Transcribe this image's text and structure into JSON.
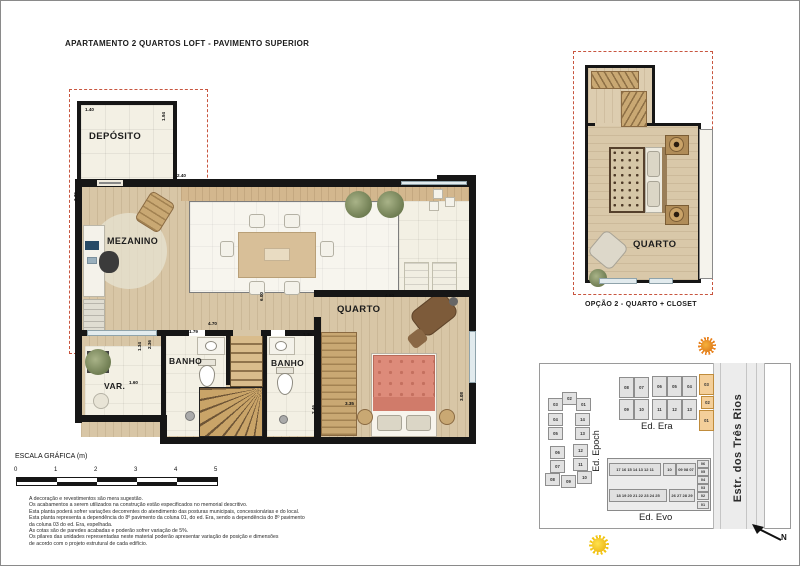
{
  "page": {
    "title": "APARTAMENTO 2 QUARTOS LOFT - PAVIMENTO SUPERIOR"
  },
  "main_plan": {
    "rooms": [
      {
        "label": "DEPÓSITO",
        "x": 88,
        "y": 130,
        "fs": 9.5
      },
      {
        "label": "MEZANINO",
        "x": 106,
        "y": 235,
        "fs": 9
      },
      {
        "label": "VAR.",
        "x": 103,
        "y": 380,
        "fs": 8.5
      },
      {
        "label": "BANHO",
        "x": 168,
        "y": 355,
        "fs": 8.5
      },
      {
        "label": "BANHO",
        "x": 270,
        "y": 357,
        "fs": 8.5
      },
      {
        "label": "QUARTO",
        "x": 336,
        "y": 303,
        "fs": 9.5
      }
    ],
    "dims": [
      {
        "t": "1.40",
        "x": 84,
        "y": 106
      },
      {
        "t": "1.94",
        "x": 160,
        "y": 120,
        "v": 1
      },
      {
        "t": "3.76",
        "x": 72,
        "y": 200,
        "v": 1
      },
      {
        "t": "2.40",
        "x": 176,
        "y": 172
      },
      {
        "t": "6.00",
        "x": 258,
        "y": 300,
        "v": 1
      },
      {
        "t": "4.60",
        "x": 384,
        "y": 292
      },
      {
        "t": "4.70",
        "x": 207,
        "y": 320
      },
      {
        "t": "1.79",
        "x": 188,
        "y": 328
      },
      {
        "t": "2.36",
        "x": 146,
        "y": 348,
        "v": 1
      },
      {
        "t": "1.34",
        "x": 136,
        "y": 350,
        "v": 1
      },
      {
        "t": "1.60",
        "x": 128,
        "y": 379
      },
      {
        "t": "1.39",
        "x": 302,
        "y": 331
      },
      {
        "t": "2.46",
        "x": 310,
        "y": 413,
        "v": 1
      },
      {
        "t": "3.35",
        "x": 344,
        "y": 400
      },
      {
        "t": "3.08",
        "x": 458,
        "y": 400,
        "v": 1
      }
    ]
  },
  "option_plan": {
    "room_label": "QUARTO",
    "caption": "OPÇÃO 2 - QUARTO + CLOSET"
  },
  "site_map": {
    "road_label": "Estr. dos Três Rios",
    "north_label": "N",
    "epoch": {
      "name": "Ed. Epoch",
      "units": [
        {
          "n": "03",
          "x": 547,
          "y": 397
        },
        {
          "n": "02",
          "x": 561,
          "y": 391
        },
        {
          "n": "01",
          "x": 575,
          "y": 397
        },
        {
          "n": "04",
          "x": 547,
          "y": 412
        },
        {
          "n": "14",
          "x": 574,
          "y": 412
        },
        {
          "n": "05",
          "x": 547,
          "y": 426
        },
        {
          "n": "13",
          "x": 574,
          "y": 426
        },
        {
          "n": "06",
          "x": 549,
          "y": 445
        },
        {
          "n": "12",
          "x": 572,
          "y": 443
        },
        {
          "n": "07",
          "x": 549,
          "y": 459
        },
        {
          "n": "11",
          "x": 572,
          "y": 457
        },
        {
          "n": "08",
          "x": 544,
          "y": 472
        },
        {
          "n": "09",
          "x": 560,
          "y": 474
        },
        {
          "n": "10",
          "x": 576,
          "y": 470
        }
      ]
    },
    "era": {
      "name": "Ed. Era",
      "units": [
        {
          "n": "08",
          "x": 618,
          "y": 376
        },
        {
          "n": "07",
          "x": 633,
          "y": 376
        },
        {
          "n": "06",
          "x": 651,
          "y": 375
        },
        {
          "n": "05",
          "x": 666,
          "y": 375
        },
        {
          "n": "04",
          "x": 681,
          "y": 375
        },
        {
          "n": "03",
          "x": 698,
          "y": 373,
          "hl": 1
        },
        {
          "n": "09",
          "x": 618,
          "y": 398
        },
        {
          "n": "10",
          "x": 633,
          "y": 398
        },
        {
          "n": "11",
          "x": 651,
          "y": 398
        },
        {
          "n": "12",
          "x": 666,
          "y": 398
        },
        {
          "n": "13",
          "x": 681,
          "y": 398
        },
        {
          "n": "02",
          "x": 700,
          "y": 395,
          "w": 13,
          "h": 13,
          "hl": 1
        },
        {
          "n": "01",
          "x": 698,
          "y": 409,
          "hl": 1
        }
      ]
    },
    "evo": {
      "name": "Ed. Evo",
      "row_top_left": "17 16 15 14 13 12 11",
      "box_top_mid": "10",
      "row_top_right": "09 08 07",
      "row_bottom_left": "18 19 20 21 22 23 24 25",
      "row_bottom_right": "26 27 28 29",
      "side_units": [
        "06",
        "05",
        "04",
        "03",
        "02",
        "01"
      ]
    }
  },
  "scale": {
    "label": "ESCALA GRÁFICA (m)",
    "ticks": [
      "0",
      "1",
      "2",
      "3",
      "4",
      "5"
    ]
  },
  "disclaimer": {
    "lines": [
      "A decoração e revestimentos são mera sugestão.",
      "Os acabamentos a serem utilizados na construção estão especificados no memorial descritivo.",
      "Esta planta poderá sofrer variações decorrentes do atendimento das posturas municipais, concessionárias e do local.",
      "Esta planta representa a dependência do 8º pavimento da coluna 01, do ed. Era, sendo a dependência do 8º pavimento",
      "da coluna 03 do ed. Era, espelhada.",
      "As cotas são de paredes acabadas e poderão sofrer variação de 5%.",
      "Os pilares das unidades representadas neste material poderão apresentar variação de posição e dimensões",
      "de acordo com o projeto estrutural de cada edifício."
    ]
  },
  "colors": {
    "dashed_outline": "#c8553f",
    "wall": "#161616",
    "wood_floor": "#d8c6a6",
    "tile_floor": "#f3f0e4",
    "unit_highlight": "#f4cf9a",
    "bed": "#dd8b7a",
    "sun_orange": "#e8821e",
    "sun_yellow": "#f2c514"
  }
}
